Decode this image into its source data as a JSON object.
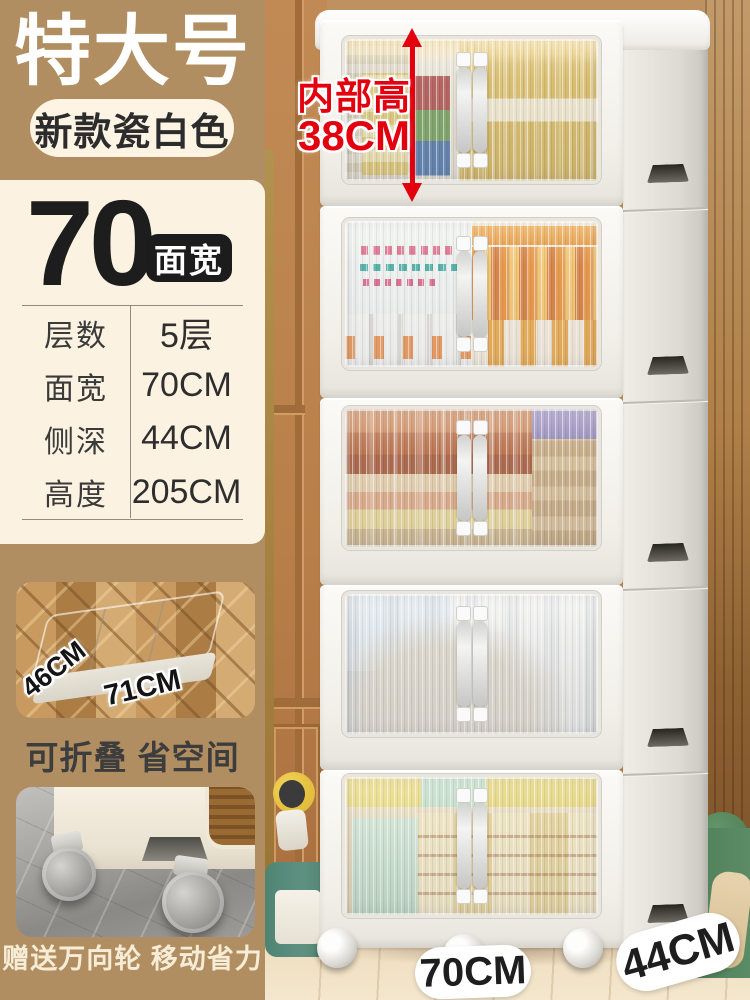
{
  "left_panel": {
    "size_badge": "特大号",
    "color_badge": "新款瓷白色",
    "spec_card": {
      "number": "70",
      "number_unit": "面宽",
      "rows": [
        {
          "label": "层数",
          "value": "5层"
        },
        {
          "label": "面宽",
          "value": "70CM"
        },
        {
          "label": "侧深",
          "value": "44CM"
        },
        {
          "label": "高度",
          "value": "205CM"
        }
      ]
    },
    "fold_inset": {
      "depth_label": "46CM",
      "width_label": "71CM",
      "caption": "可折叠 省空间"
    },
    "wheel_inset": {
      "caption": "赠送万向轮 移动省力"
    }
  },
  "photo": {
    "height_annotation": {
      "line1": "内部高",
      "line2": "38CM"
    },
    "width_pill": "70CM",
    "depth_pill": "44CM",
    "tier_count": 5
  },
  "colors": {
    "background_tan": "#b18e61",
    "card_cream": "#fbf2e1",
    "pill_cream": "#fdf4e3",
    "badge_black": "#1c1c1c",
    "accent_red": "#e3000f",
    "caption_dark": "#3d3d3d",
    "caption_cream": "#f7edd7",
    "cabinet_white": "#f6f4ef"
  }
}
